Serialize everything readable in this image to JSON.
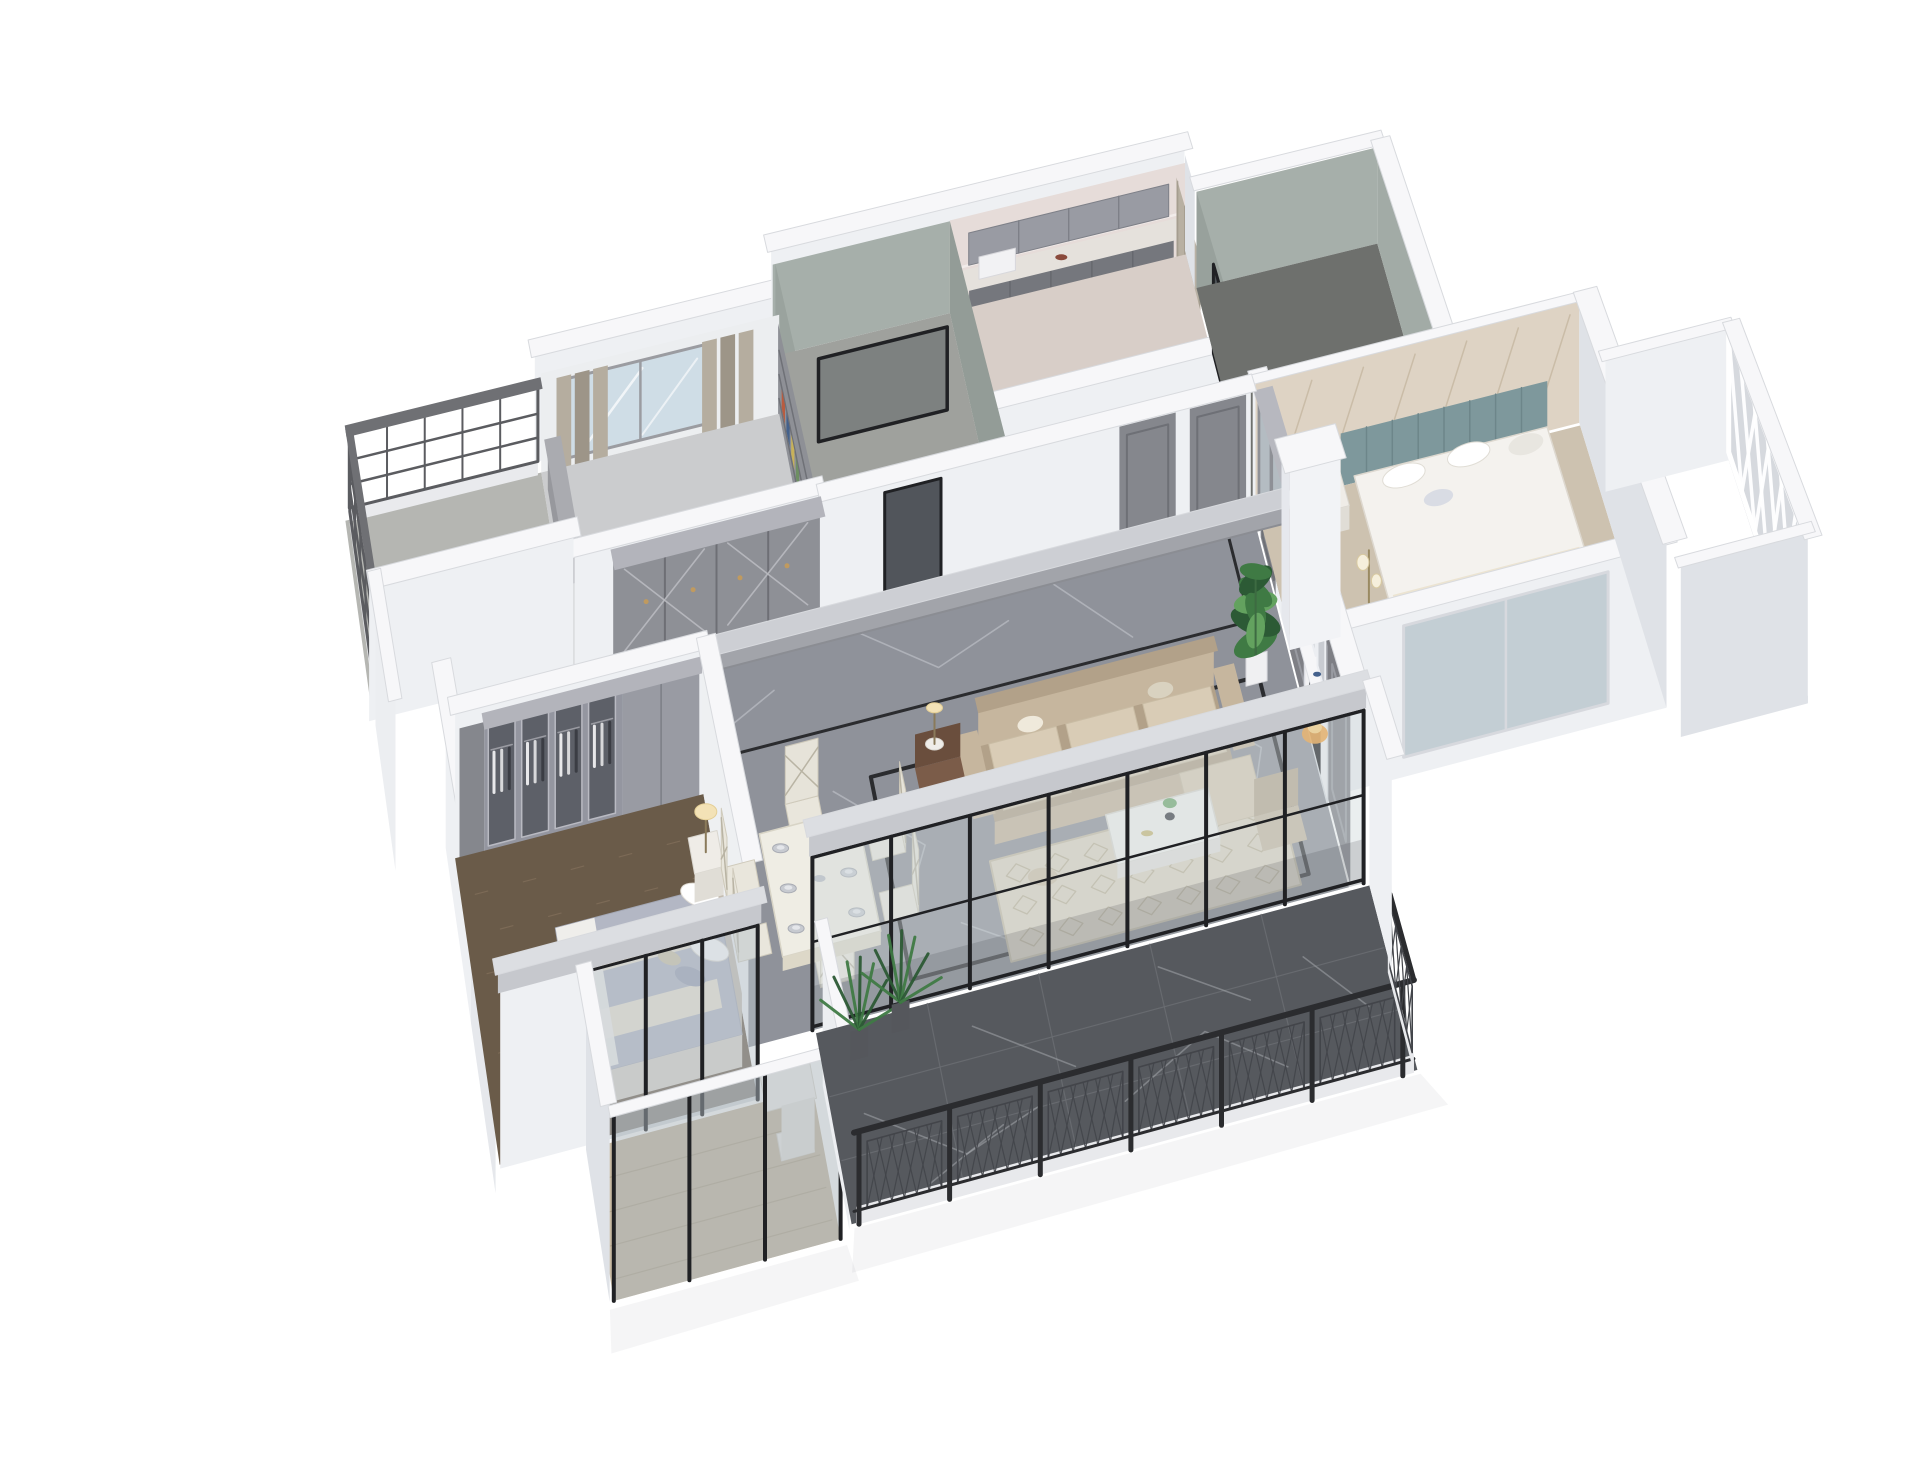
{
  "scene": {
    "label": "3D cutaway dollhouse rendering of an apartment floor plan on a white background",
    "type": "architectural-render",
    "background": "#ffffff",
    "has_text": false
  },
  "palette": {
    "bg": "#ffffff",
    "wallTop": "#f7f7f9",
    "wallFace": "#eef0f3",
    "wallFaceMid": "#dfe2e7",
    "wallFaceDark": "#cbced5",
    "wallEdge": "#d8dade",
    "panelGray": "#8e9096",
    "panelGrayDark": "#75777d",
    "doorGray": "#85878d",
    "closetGray": "#999ba3",
    "marble": "#8f929a",
    "marbleVein": "#c9cbd1",
    "inlay": "#2b2c2f",
    "darkMarble": "#56595e",
    "darkVein": "#aaadb2",
    "woodDark": "#6a5b49",
    "woodSpeck": "#8a7660",
    "woodLight": "#c9bba4",
    "plankLine": "#ad9e85",
    "bathWall": "#a6afaa",
    "bathWallDark": "#939c97",
    "bathFloor": "#9fa19d",
    "pinkWall": "#e6dcd9",
    "pinkTrim": "#f2ecea",
    "curtain": "#b5ad9f",
    "curtainDark": "#9d9588",
    "glass": "#cfdde6",
    "glassDark": "#3f444a",
    "frameBlack": "#202124",
    "railBlack": "#2b2c2f",
    "railMesh": "#43454a",
    "sofa": "#c6b69e",
    "sofaDark": "#b2a189",
    "cushion": "#d9ccb6",
    "brownChair": "#7b5c49",
    "rug": "#ddd5c3",
    "rugLine": "#b7aa8e",
    "tableWhite": "#efede4",
    "chairWhite": "#e9e6dc",
    "plate": "#c7cad0",
    "bedWhite": "#f4f2ee",
    "duvetBlue": "#b3b7c4",
    "blanketCream": "#ece4d2",
    "pillowBlue": "#9aa1b5",
    "headboard": "#c4bcb0",
    "tealHead": "#7e989c",
    "tileWall": "#ded3c4",
    "tileLine": "#c4b7a0",
    "mirror": "#b6bfc4",
    "wardrobeGlass": "#585b63",
    "lampGlow": "#f3e2b6",
    "brass": "#c09a5f",
    "mantel": "#f2f2f4",
    "fireDark": "#17181b",
    "fire": "#f59b2e",
    "fireIn": "#ffd27a",
    "plant": "#3f7a44",
    "plantDark": "#2c5a35",
    "plantLight": "#63a25f",
    "pot": "#f0f0f2",
    "floorGrayRoom": "#cbccce",
    "concrete": "#b5b6b2",
    "lattice": "#5b5c60",
    "whiteLattice": "#ffffff",
    "shadow": "#3c4048"
  },
  "rooms": [
    "north-balcony",
    "study",
    "bathroom-1",
    "laundry-room",
    "bathroom-2",
    "east-bedroom",
    "east-balcony",
    "entry-hall",
    "living-room",
    "dining-area",
    "master-bedroom",
    "master-balcony",
    "south-balcony"
  ],
  "furniture": [
    "study-window",
    "bookshelf",
    "wall-cabinets",
    "black-glass-door",
    "hall-wardrobes",
    "interior-doors",
    "ceiling-beam",
    "feature-wall",
    "fireplace",
    "wall-art-frames",
    "monstera-plant",
    "sofa",
    "leather-armchair",
    "area-rug",
    "coffee-table",
    "side-lamp",
    "dining-table",
    "dining-chairs",
    "tableware",
    "master-wardrobe",
    "master-bed",
    "nightstand",
    "table-lamp",
    "bed-teal-headboard",
    "bedside-lamp",
    "floor-lamp",
    "mirrored-wardrobe",
    "glass-sliding-doors",
    "balcony-railing",
    "white-lattice-screen",
    "balcony-plants",
    "desk-and-chair"
  ]
}
